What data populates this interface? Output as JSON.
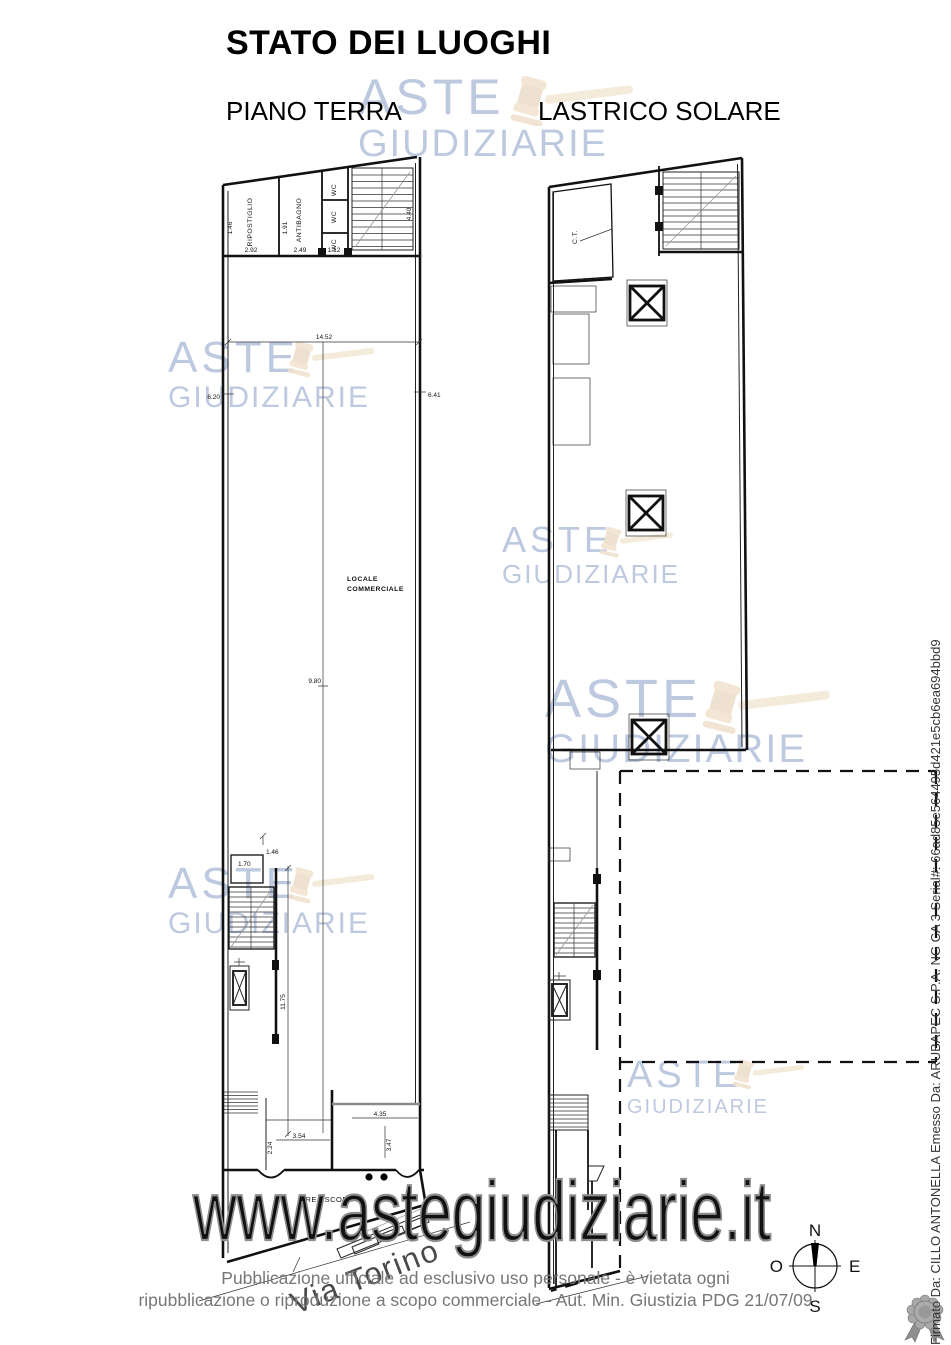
{
  "header": {
    "title": "STATO DEI LUOGHI",
    "plan_left_label": "PIANO TERRA",
    "plan_right_label": "LASTRICO SOLARE"
  },
  "watermark": {
    "line1": "ASTE",
    "line2": "GIUDIZIARIE",
    "url": "www.astegiudiziarie.it",
    "text_color": "#aab8d8",
    "gavel_color": "#ddbd92",
    "url_outline_color": "#8d8d8d"
  },
  "piano_terra": {
    "rooms": {
      "ripostiglio": "RIPOSTIGLIO",
      "antibagno": "ANTIBAGNO",
      "wc1": "WC",
      "wc2": "WC",
      "wc3": "WC",
      "locale_line1": "LOCALE",
      "locale_line2": "COMMERCIALE",
      "area_scop": "AREA SCOP."
    },
    "dims": {
      "top_width": "14.52",
      "left_side": "6.20",
      "right_side": "6.41",
      "hall": "9.80",
      "stair_side": "11.75",
      "ripostiglio_w": "2.92",
      "antibagno_w": "2.49",
      "wc_w": "1.12",
      "ripostiglio_h": "1.46",
      "antibagno_h": "1.91",
      "stair_h": "4.40",
      "small_room_w": "1.70",
      "small_room_h": "1.46",
      "back_depth": "2.24",
      "back_w1": "3.54",
      "back_w2": "4.35",
      "back_h": "3.47"
    }
  },
  "lastrico": {
    "rooms": {
      "ct": "C.T."
    }
  },
  "street": {
    "name": "Via Torino"
  },
  "compass": {
    "n": "N",
    "s": "S",
    "e": "E",
    "o": "O"
  },
  "footer": {
    "line1": "Pubblicazione ufficiale ad esclusivo uso personale - è vietata ogni",
    "line2": "ripubblicazione o riproduzione a scopo commerciale - Aut. Min. Giustizia PDG 21/07/09"
  },
  "signature": {
    "text": "Firmato Da: CILLO ANTONELLA Emesso Da: ARUBAPEC S.P.A. NG CA 3 Serial#: 66ad85e564495d421e5cb6ea694bbd9"
  }
}
